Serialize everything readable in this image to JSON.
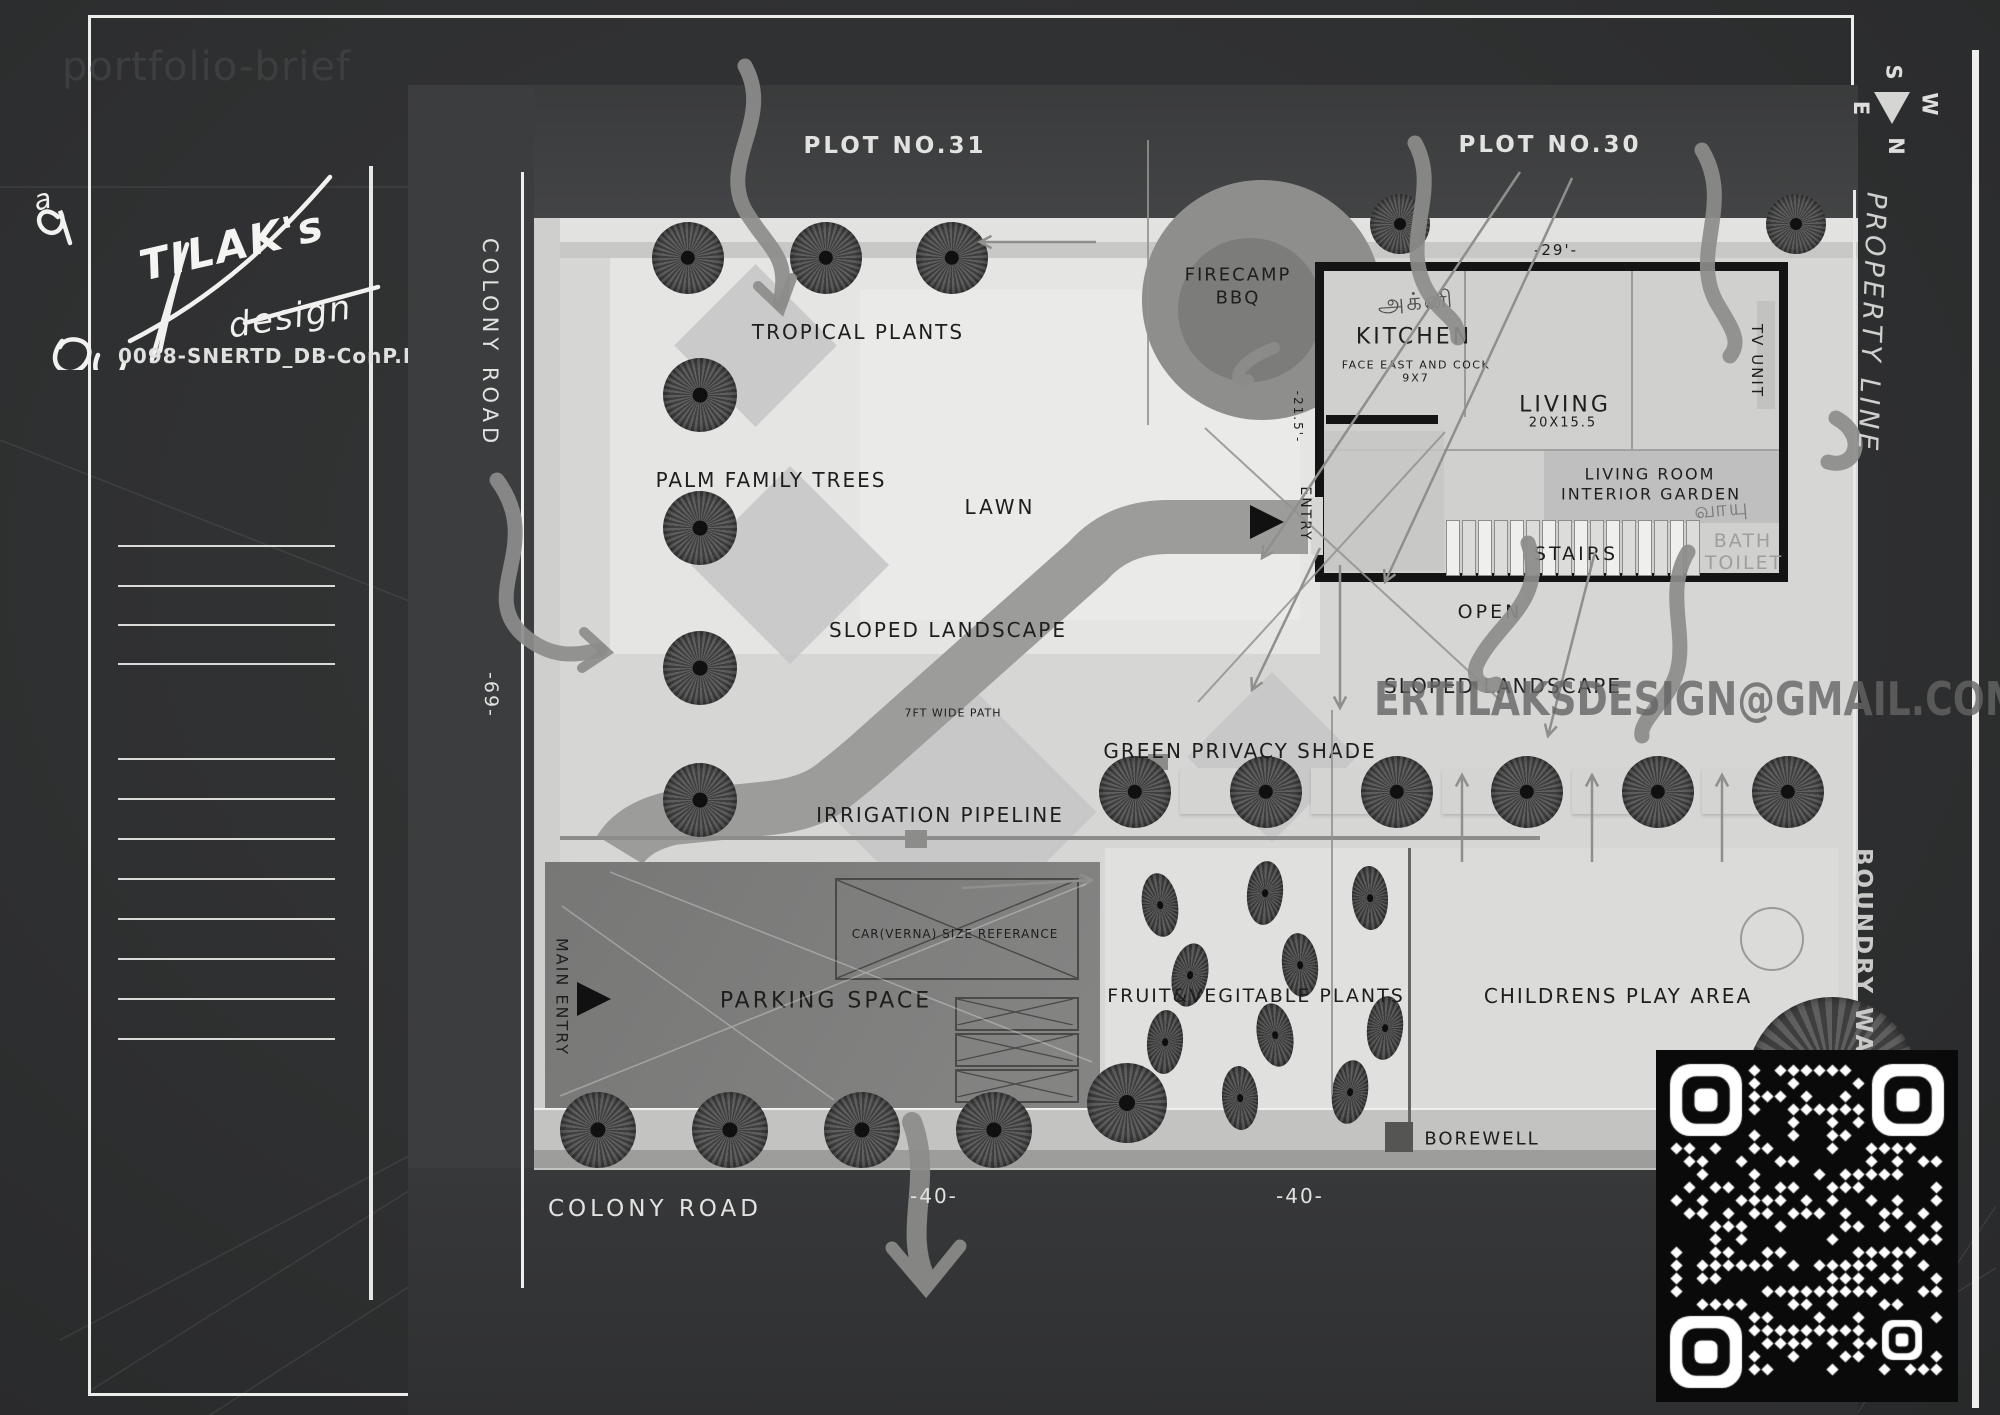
{
  "page": {
    "portfolio_label": "portfolio-brief",
    "drawing_code": "0098-SNERTD_DB-ConP.R0",
    "watermark_email": "ERTILAKSDESIGN@GMAIL.COM"
  },
  "signature": {
    "prefix": "a",
    "name": "TILAK's",
    "suffix": "design"
  },
  "compass": {
    "top": "S",
    "left": "E",
    "right": "W",
    "bottom": "N"
  },
  "plots": {
    "left": "PLOT NO.31",
    "right": "PLOT NO.30"
  },
  "roads": {
    "left_vertical": "COLONY ROAD",
    "bottom": "COLONY ROAD"
  },
  "boundaries": {
    "property_line": "PROPERTY LINE",
    "boundary_wall": "BOUNDRY WALL"
  },
  "dimensions": {
    "road_left": "-69-",
    "road_bottom_1": "-40-",
    "road_bottom_2": "-40-",
    "house_top": "-29'-",
    "house_side": "-21.5'-"
  },
  "landscape": {
    "tropical_plants": "TROPICAL PLANTS",
    "palm_family_trees": "PALM FAMILY TREES",
    "lawn": "LAWN",
    "firecamp_line1": "FIRECAMP",
    "firecamp_line2": "BBQ",
    "sloped_landscape_left": "SLOPED LANDSCAPE",
    "sloped_landscape_right": "SLOPED LANDSCAPE",
    "path_7ft": "7FT WIDE PATH",
    "green_privacy_shade": "GREEN PRIVACY SHADE",
    "irrigation_pipeline": "IRRIGATION PIPELINE",
    "open_area": "OPEN",
    "fruit_veg": "FRUIT&VEGITABLE PLANTS",
    "childrens_play": "CHILDRENS PLAY AREA",
    "borewell": "BOREWELL",
    "parking": "PARKING SPACE",
    "car_box": "CAR(VERNA) SIZE REFERANCE",
    "main_entry": "MAIN ENTRY"
  },
  "house": {
    "kitchen": "KITCHEN",
    "kitchen_note": "FACE EAST AND COCK",
    "kitchen_size": "9X7",
    "living": "LIVING",
    "living_size": "20X15.5",
    "tv_unit": "TV UNIT",
    "living_room": "LIVING ROOM",
    "interior_garden": "INTERIOR GARDEN",
    "stairs": "STAIRS",
    "bath": "BATH",
    "toilet": "TOILET",
    "entry": "ENTRY",
    "vastu_kitchen": "அக்னி",
    "vastu_garden": "வாயு"
  }
}
